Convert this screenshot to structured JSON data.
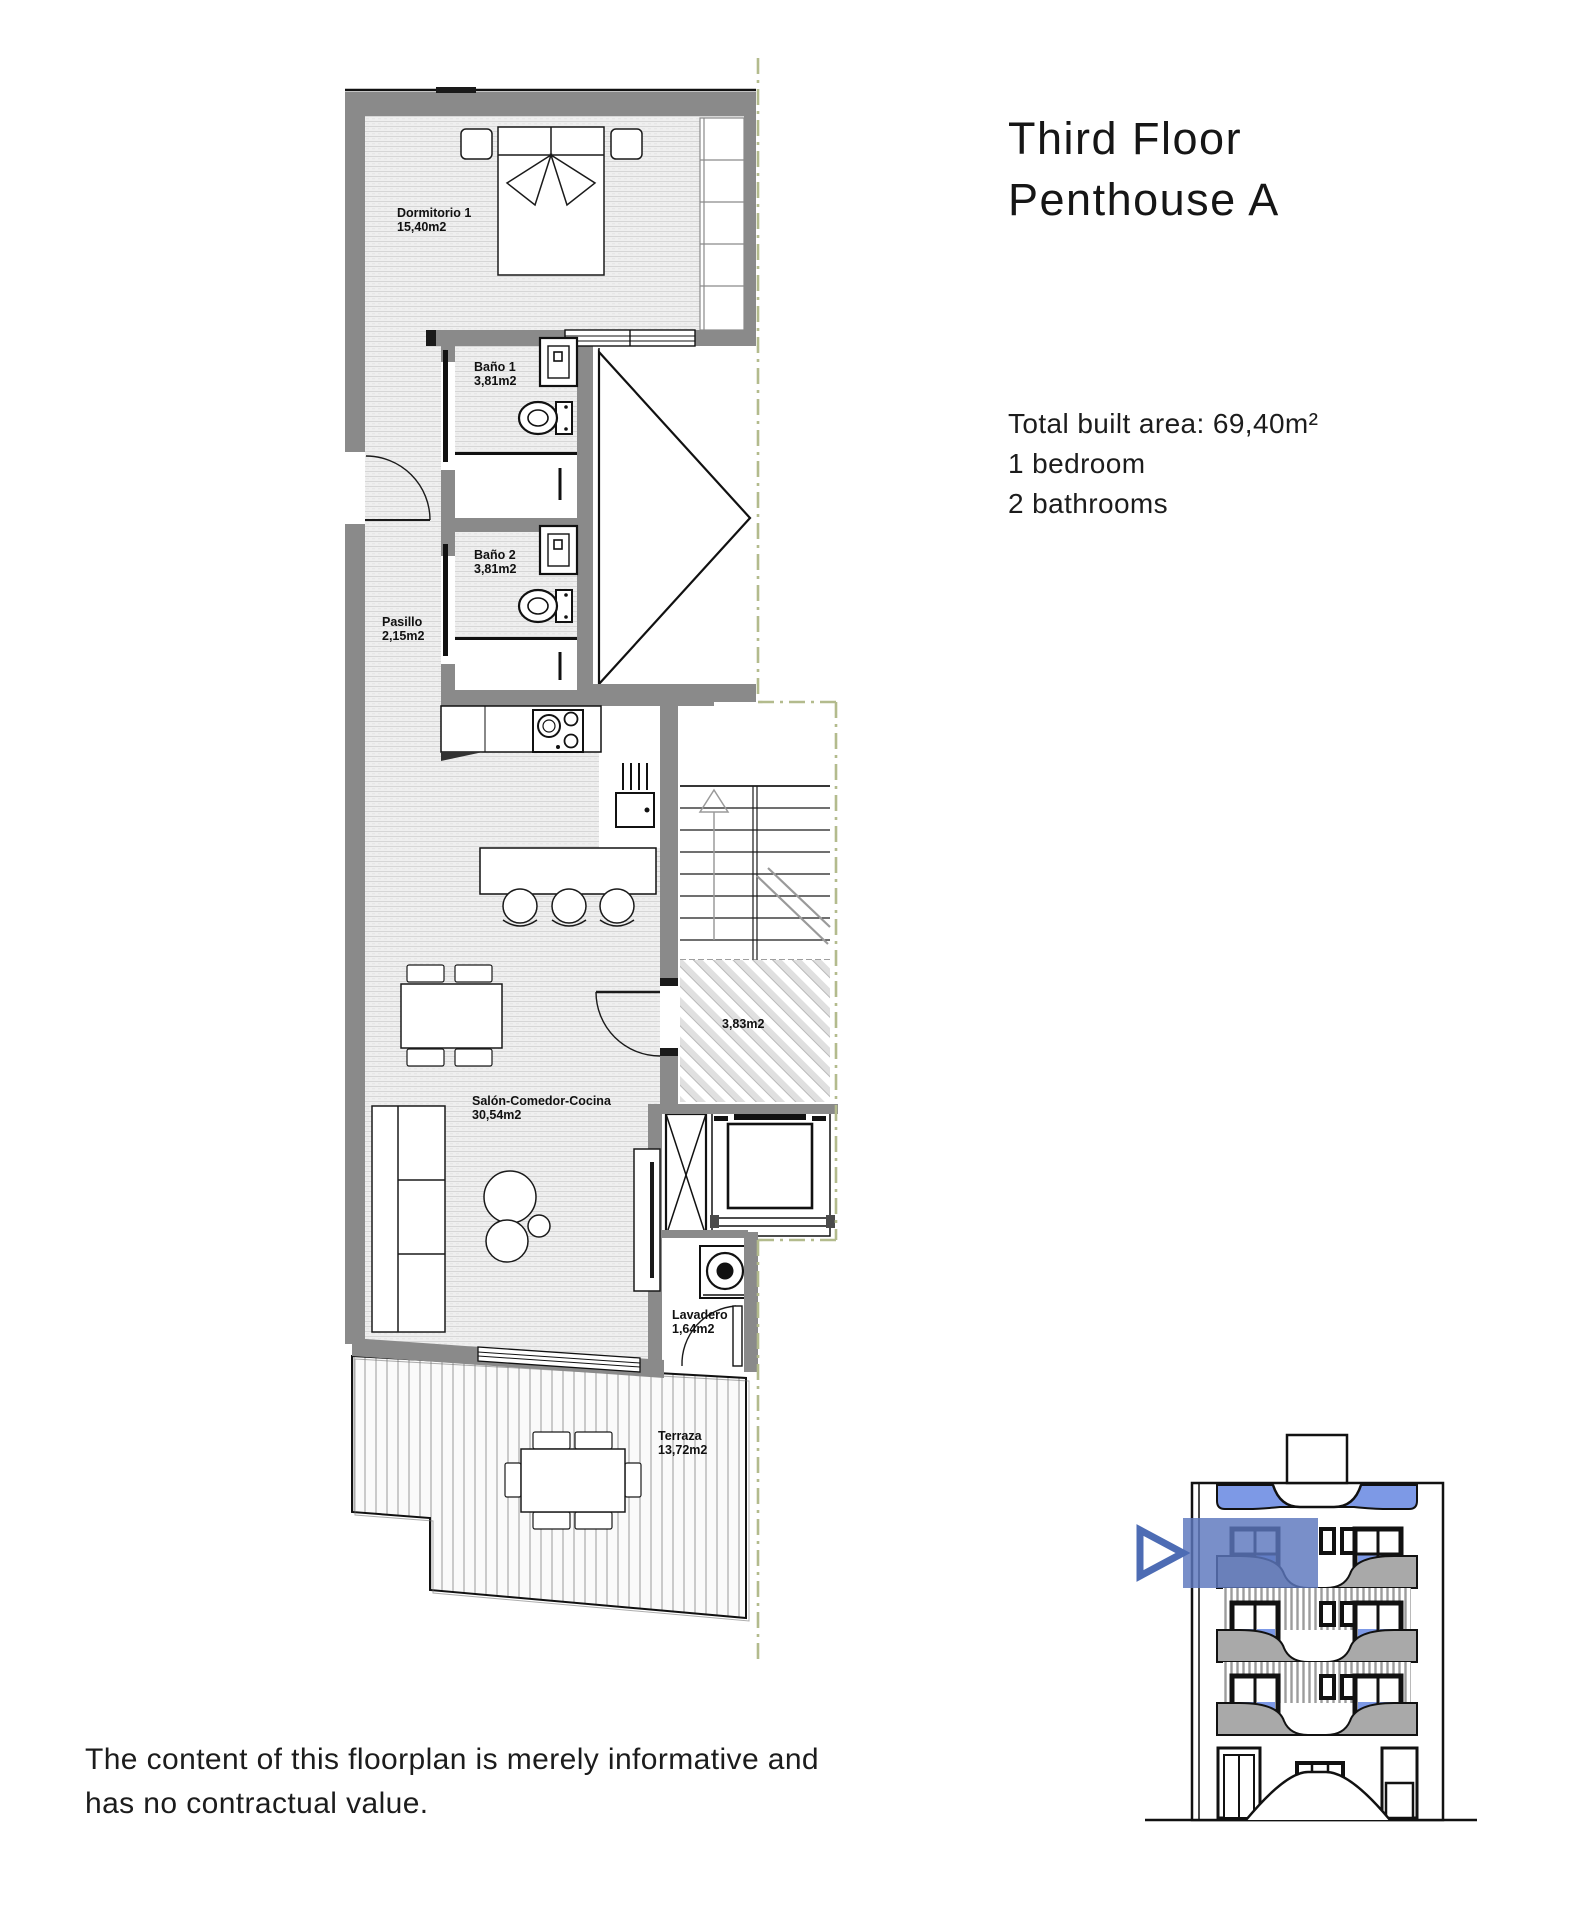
{
  "header": {
    "title_line1": "Third Floor",
    "title_line2": "Penthouse A"
  },
  "summary": {
    "total_area": "Total built area: 69,40m²",
    "bedrooms": "1 bedroom",
    "bathrooms": "2 bathrooms"
  },
  "rooms": {
    "dormitorio": {
      "name": "Dormitorio 1",
      "area": "15,40m2"
    },
    "bano1": {
      "name": "Baño 1",
      "area": "3,81m2"
    },
    "bano2": {
      "name": "Baño 2",
      "area": "3,81m2"
    },
    "pasillo": {
      "name": "Pasillo",
      "area": "2,15m2"
    },
    "salon": {
      "name": "Salón-Comedor-Cocina",
      "area": "30,54m2"
    },
    "landing": {
      "area": "3,83m2"
    },
    "lavadero": {
      "name": "Lavadero",
      "area": "1,64m2"
    },
    "terraza": {
      "name": "Terraza",
      "area": "13,72m2"
    }
  },
  "disclaimer": {
    "line1": "The content of this floorplan is merely informative and",
    "line2": "has no contractual value."
  },
  "colors": {
    "wall_gray": "#8a8a8a",
    "line_black": "#1a1a1a",
    "boundary_dash_olive": "#b3bb8d",
    "highlight_blue": "#5b76bd",
    "window_blue": "#7d99e6",
    "balcony_gray": "#a9a9a9",
    "floor_fill": "#efefef"
  }
}
